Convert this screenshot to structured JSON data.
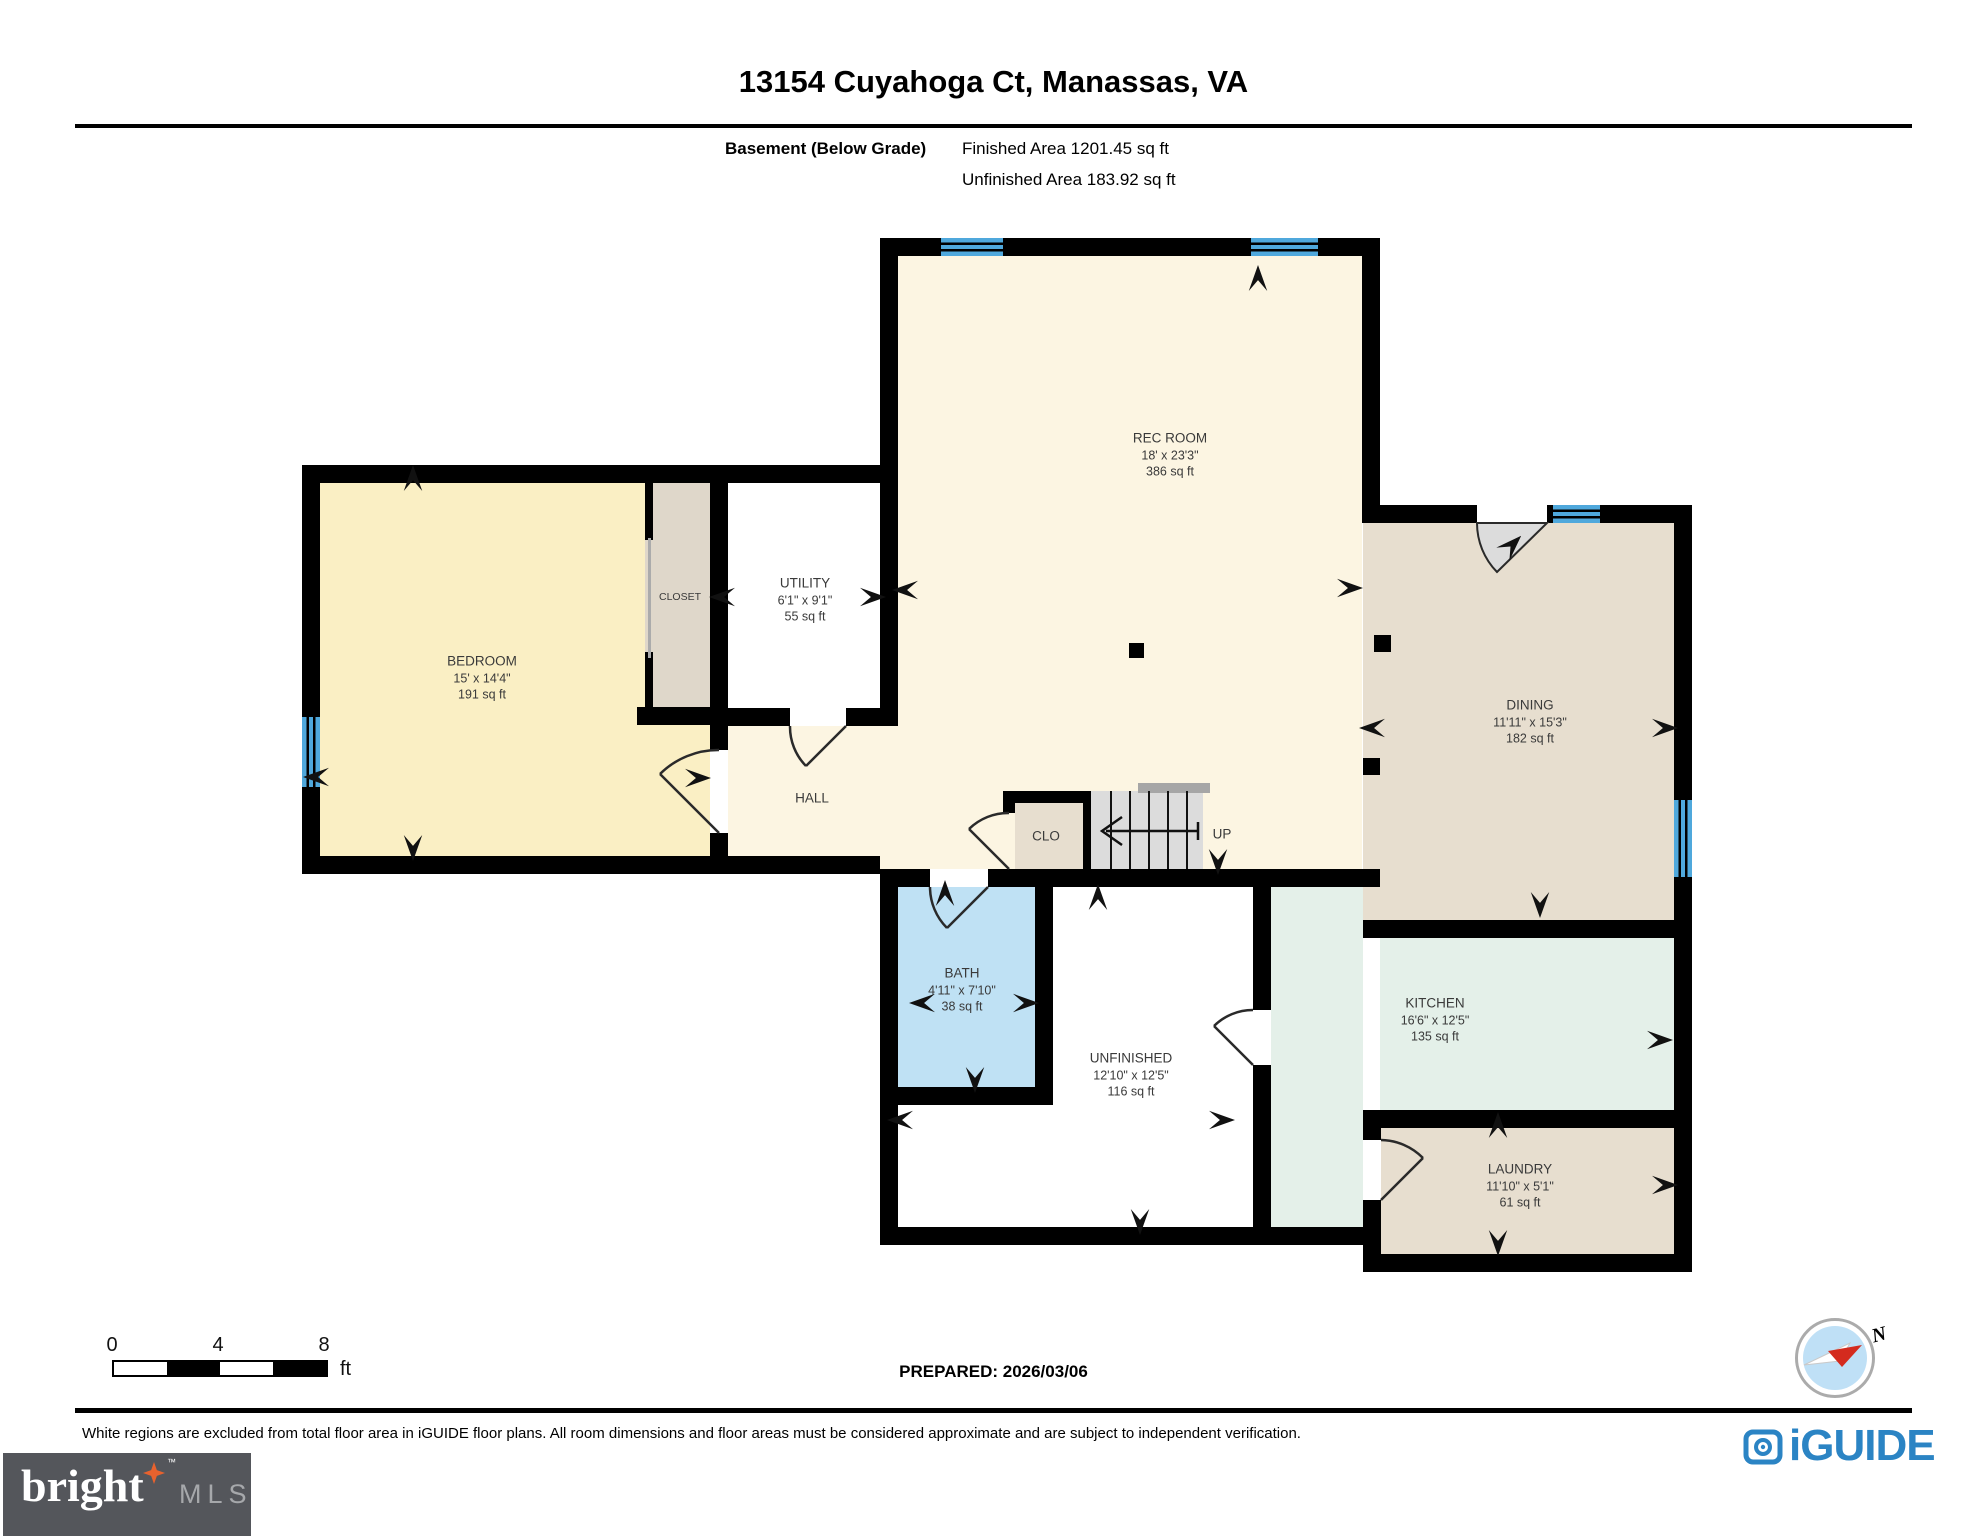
{
  "header": {
    "title": "13154 Cuyahoga Ct, Manassas, VA",
    "floor_label": "Basement (Below Grade)",
    "finished_area": "Finished Area 1201.45 sq ft",
    "unfinished_area": "Unfinished Area 183.92 sq ft"
  },
  "rooms": {
    "rec_room": {
      "name": "REC ROOM",
      "dims": "18' x 23'3\"",
      "area": "386 sq ft"
    },
    "bedroom": {
      "name": "BEDROOM",
      "dims": "15' x 14'4\"",
      "area": "191 sq ft"
    },
    "closet": {
      "name": "CLOSET"
    },
    "utility": {
      "name": "UTILITY",
      "dims": "6'1\" x 9'1\"",
      "area": "55 sq ft"
    },
    "hall": {
      "name": "HALL"
    },
    "clo": {
      "name": "CLO"
    },
    "stairs": {
      "name": "UP"
    },
    "dining": {
      "name": "DINING",
      "dims": "11'11\" x 15'3\"",
      "area": "182 sq ft"
    },
    "bath": {
      "name": "BATH",
      "dims": "4'11\" x 7'10\"",
      "area": "38 sq ft"
    },
    "unfinished": {
      "name": "UNFINISHED",
      "dims": "12'10\" x 12'5\"",
      "area": "116 sq ft"
    },
    "kitchen": {
      "name": "KITCHEN",
      "dims": "16'6\" x 12'5\"",
      "area": "135 sq ft"
    },
    "laundry": {
      "name": "LAUNDRY",
      "dims": "11'10\" x 5'1\"",
      "area": "61 sq ft"
    }
  },
  "scale_bar": {
    "ticks": [
      "0",
      "4",
      "8"
    ],
    "unit": "ft"
  },
  "footer": {
    "prepared": "PREPARED: 2026/03/06",
    "disclaimer": "White regions are excluded from total floor area in iGUIDE floor plans. All room dimensions and floor areas must be considered approximate and are subject to independent verification.",
    "compass_north": "N"
  },
  "logos": {
    "iguide": "iGUIDE",
    "bright": "bright",
    "bright_tm": "™",
    "mls": "MLS"
  },
  "colors": {
    "wall": "#000000",
    "window_blue": "#4FA8DC",
    "finished_cream": "#FCF5E2",
    "bedroom_yellow": "#FAEFC4",
    "tan": "#E7DECF",
    "bath_blue": "#BFE1F4",
    "kitchen_green": "#E4F0E9",
    "stairs_gray": "#DCDCDC",
    "iguide_blue": "#2B84C4",
    "bright_bg": "#54565B",
    "compass_red": "#D42B1E",
    "star_orange": "#E8622E"
  }
}
